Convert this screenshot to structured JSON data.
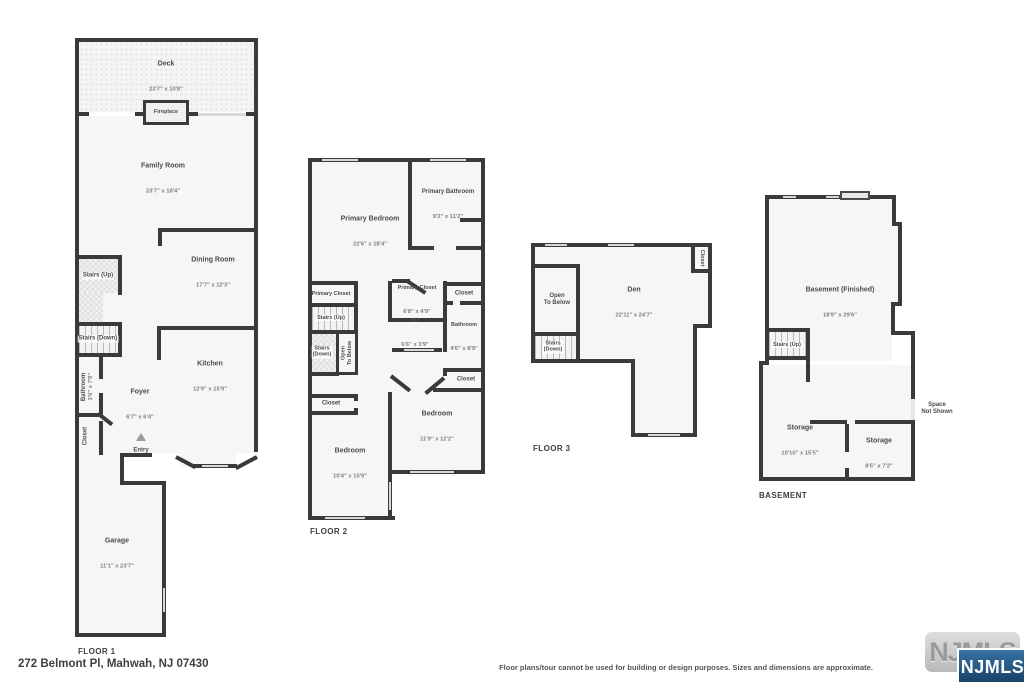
{
  "page": {
    "address": "272 Belmont Pl, Mahwah, NJ 07430",
    "disclaimer": "Floor plans/tour cannot be used for building or design purposes. Sizes and dimensions are approximate.",
    "watermark": "NJMLS",
    "logo_badge": "NJMLS"
  },
  "colors": {
    "wall": "#3a3a3a",
    "room_fill": "#f6f6f6",
    "window": "#d8d8d8",
    "label_text": "#4b4b4b",
    "dims_text": "#7e7e7e",
    "logo_blue": "#2a5f8a"
  },
  "floor1": {
    "label": "FLOOR 1",
    "rooms": {
      "deck": {
        "name": "Deck",
        "dims": "23'7\" x 10'8\""
      },
      "fireplace": {
        "name": "Fireplace"
      },
      "family_room": {
        "name": "Family Room",
        "dims": "23'7\" x 18'4\""
      },
      "stairs_up": {
        "name": "Stairs (Up)"
      },
      "dining_room": {
        "name": "Dining Room",
        "dims": "17'7\" x 12'3\""
      },
      "stairs_down": {
        "name": "Stairs (Down)"
      },
      "bathroom": {
        "name": "Bathroom",
        "dims": "3'6\" x 7'8\""
      },
      "kitchen": {
        "name": "Kitchen",
        "dims": "12'9\" x 15'9\""
      },
      "foyer": {
        "name": "Foyer",
        "dims": "6'7\" x 6'4\""
      },
      "closet": {
        "name": "Closet"
      },
      "entry": {
        "name": "Entry"
      },
      "garage": {
        "name": "Garage",
        "dims": "11'1\" x 23'7\""
      }
    }
  },
  "floor2": {
    "label": "FLOOR 2",
    "rooms": {
      "primary_bedroom": {
        "name": "Primary Bedroom",
        "dims": "22'6\" x 18'4\""
      },
      "primary_bathroom": {
        "name": "Primary Bathroom",
        "dims": "9'2\" x 11'2\""
      },
      "primary_closet_left": {
        "name": "Primary Closet"
      },
      "stairs_up": {
        "name": "Stairs (Up)"
      },
      "stairs_down": {
        "name": "Stairs\n(Down)"
      },
      "open_to_below": {
        "name": "Open\nTo Below"
      },
      "primary_closet": {
        "name": "Primary Closet",
        "dims": "6'8\" x 4'9\""
      },
      "closet_top": {
        "name": "Closet"
      },
      "wd": {
        "name": "W/d",
        "dims": "6'6\" x 3'9\""
      },
      "bathroom": {
        "name": "Bathroom",
        "dims": "4'6\" x 8'9\""
      },
      "closet_mid": {
        "name": "Closet"
      },
      "closet_left": {
        "name": "Closet"
      },
      "bedroom_left": {
        "name": "Bedroom",
        "dims": "10'4\" x 15'9\""
      },
      "bedroom_right": {
        "name": "Bedroom",
        "dims": "11'9\" x 12'2\""
      }
    }
  },
  "floor3": {
    "label": "FLOOR 3",
    "rooms": {
      "open_to_below": {
        "name": "Open\nTo Below"
      },
      "den": {
        "name": "Den",
        "dims": "22'11\" x 24'7\""
      },
      "closet": {
        "name": "Closet"
      },
      "stairs_down": {
        "name": "Stairs\n(Down)"
      }
    }
  },
  "basement": {
    "label": "BASEMENT",
    "rooms": {
      "basement": {
        "name": "Basement (Finished)",
        "dims": "18'9\" x 29'6\""
      },
      "stairs_up": {
        "name": "Stairs (Up)"
      },
      "storage_left": {
        "name": "Storage",
        "dims": "10'10\" x 15'5\""
      },
      "storage_right": {
        "name": "Storage",
        "dims": "8'5\" x 7'2\""
      },
      "space_not_shown": {
        "name": "Space\nNot Shown"
      }
    }
  }
}
